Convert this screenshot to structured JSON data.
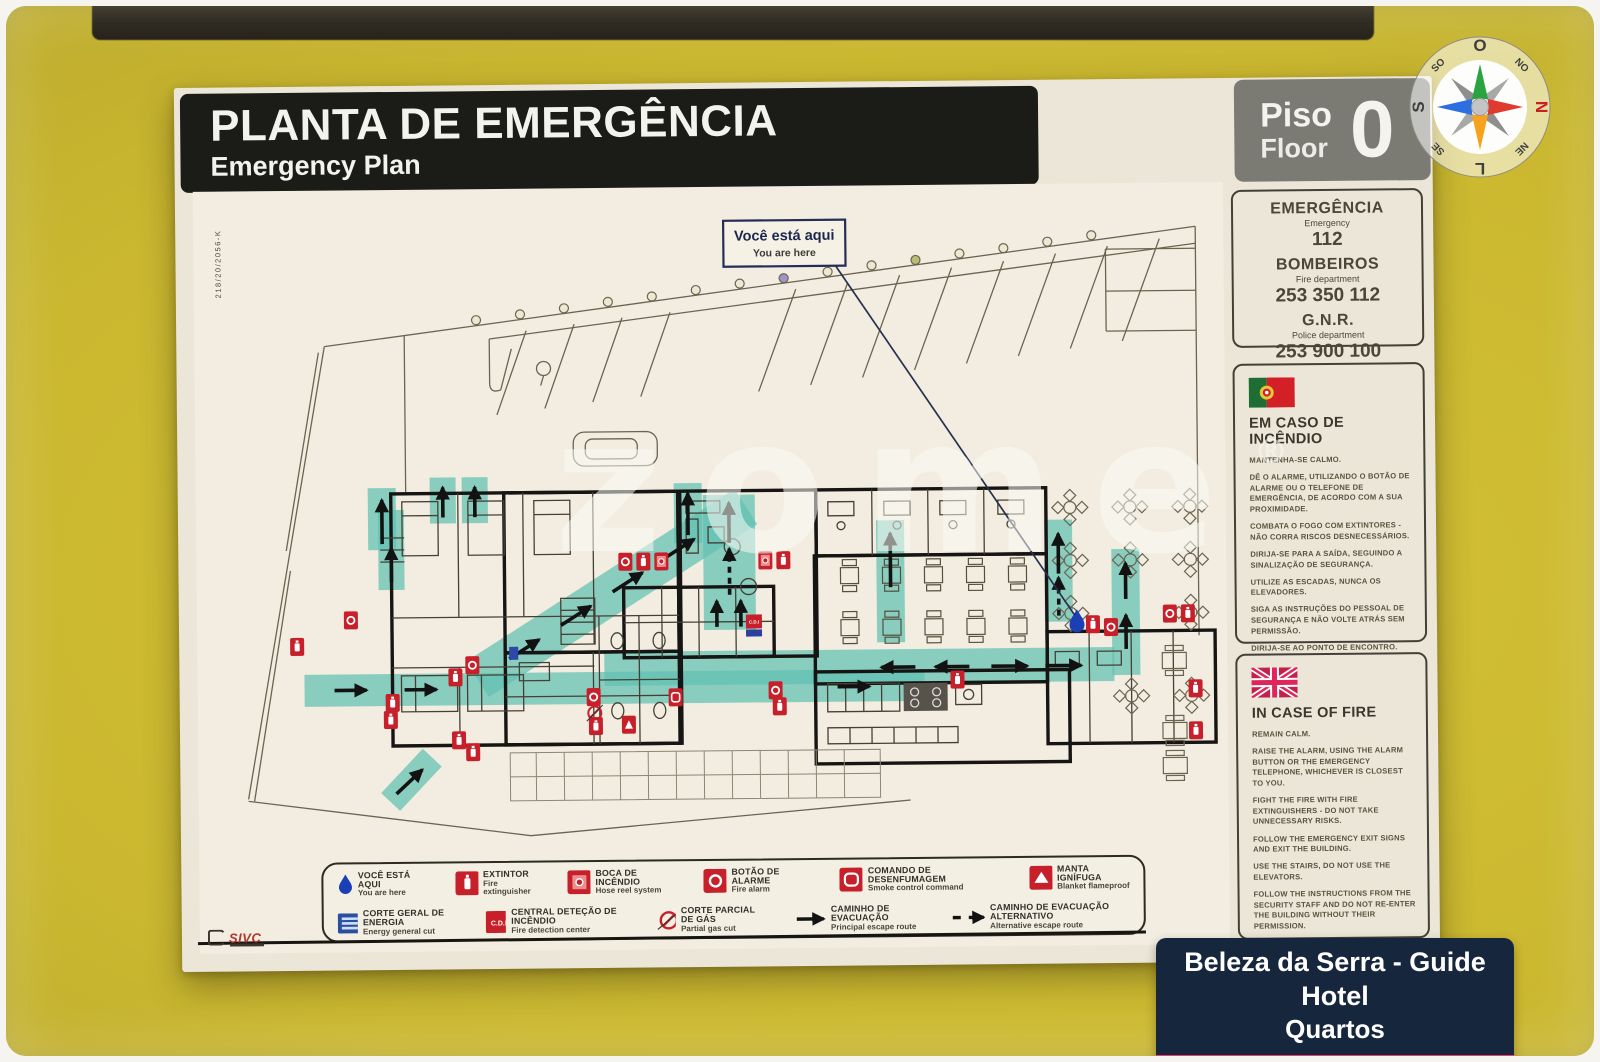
{
  "sign": {
    "title_pt": "PLANTA DE EMERGÊNCIA",
    "title_en": "Emergency Plan",
    "floor_pt": "Piso",
    "floor_en": "Floor",
    "floor_number": "0",
    "ref_code": "218/20/2056-K",
    "maker": "SIVC"
  },
  "compass": {
    "n": "N",
    "s": "S",
    "e": "L",
    "w": "O",
    "ne": "NE",
    "nw": "NO",
    "se": "SE",
    "sw": "SO"
  },
  "contacts": [
    {
      "name_pt": "EMERGÊNCIA",
      "name_en": "Emergency",
      "number": "112"
    },
    {
      "name_pt": "BOMBEIROS",
      "name_en": "Fire department",
      "number": "253 350 112"
    },
    {
      "name_pt": "G.N.R.",
      "name_en": "Police department",
      "number": "253 900 100"
    }
  ],
  "fire_pt": {
    "title": "EM CASO DE INCÊNDIO",
    "steps": [
      "MANTENHA-SE CALMO.",
      "DÊ O ALARME, UTILIZANDO O BOTÃO DE ALARME OU O TELEFONE DE EMERGÊNCIA, DE ACORDO COM A SUA PROXIMIDADE.",
      "COMBATA O FOGO COM EXTINTORES - NÃO CORRA RISCOS DESNECESSÁRIOS.",
      "DIRIJA-SE PARA A SAÍDA, SEGUINDO A SINALIZAÇÃO DE SEGURANÇA.",
      "UTILIZE AS ESCADAS, NUNCA OS ELEVADORES.",
      "SIGA AS INSTRUÇÕES DO PESSOAL DE SEGURANÇA E NÃO VOLTE ATRÁS SEM PERMISSÃO.",
      "DIRIJA-SE AO PONTO DE ENCONTRO."
    ]
  },
  "fire_en": {
    "title": "IN CASE OF FIRE",
    "steps": [
      "REMAIN CALM.",
      "RAISE THE ALARM, USING THE ALARM BUTTON OR THE EMERGENCY TELEPHONE, WHICHEVER IS CLOSEST TO YOU.",
      "FIGHT THE FIRE WITH FIRE EXTINGUISHERS - DO NOT TAKE UNNECESSARY RISKS.",
      "FOLLOW THE EMERGENCY EXIT SIGNS AND EXIT THE BUILDING.",
      "USE THE STAIRS, DO NOT USE THE ELEVATORS.",
      "FOLLOW THE INSTRUCTIONS FROM THE SECURITY STAFF AND DO NOT RE-ENTER THE BUILDING WITHOUT THEIR PERMISSION.",
      "GO TO THE MEETING POINT."
    ]
  },
  "plan": {
    "you_are_here_pt": "Você está aqui",
    "you_are_here_en": "You are here"
  },
  "legend": {
    "row1": [
      {
        "icon": "you-are-here-drop",
        "pt": "VOCÊ ESTÁ AQUI",
        "en": "You are here"
      },
      {
        "icon": "fire-extinguisher",
        "pt": "EXTINTOR",
        "en": "Fire extinguisher"
      },
      {
        "icon": "hose-reel",
        "pt": "BOCA DE INCÊNDIO",
        "en": "Hose reel system"
      },
      {
        "icon": "alarm-button",
        "pt": "BOTÃO DE ALARME",
        "en": "Fire alarm"
      },
      {
        "icon": "smoke-control",
        "pt": "COMANDO DE DESENFUMAGEM",
        "en": "Smoke control command"
      },
      {
        "icon": "fire-blanket",
        "pt": "MANTA IGNÍFUGA",
        "en": "Blanket flameproof"
      }
    ],
    "row2": [
      {
        "icon": "energy-cut",
        "pt": "CORTE GERAL DE ENERGIA",
        "en": "Energy general cut"
      },
      {
        "icon": "cdi",
        "cdi_label": "C.D.I",
        "pt": "CENTRAL DETEÇÃO DE INCÊNDIO",
        "en": "Fire detection center"
      },
      {
        "icon": "gas-cut",
        "pt": "CORTE PARCIAL DE GÁS",
        "en": "Partial gas cut"
      },
      {
        "icon": "escape-route",
        "pt": "CAMINHO DE EVACUAÇÃO",
        "en": "Principal escape route"
      },
      {
        "icon": "alt-escape-route",
        "pt": "CAMINHO DE EVACUAÇÃO ALTERNATIVO",
        "en": "Alternative escape route"
      }
    ]
  },
  "watermark": {
    "text": "zome",
    "reg": "®"
  },
  "footer": {
    "line1": "Beleza da Serra - Guide Hotel",
    "line2": "Quartos"
  },
  "colors": {
    "wall": "#cbb830",
    "board": "#ebe6d8",
    "banner": "#1b1b18",
    "floor_box": "#7b7b73",
    "route_teal": "#5fc0b2",
    "safety_red": "#c8202a",
    "badge_navy": "#16263c",
    "badge_pink": "#ee3a6e",
    "drop_blue": "#1b3fb5"
  }
}
